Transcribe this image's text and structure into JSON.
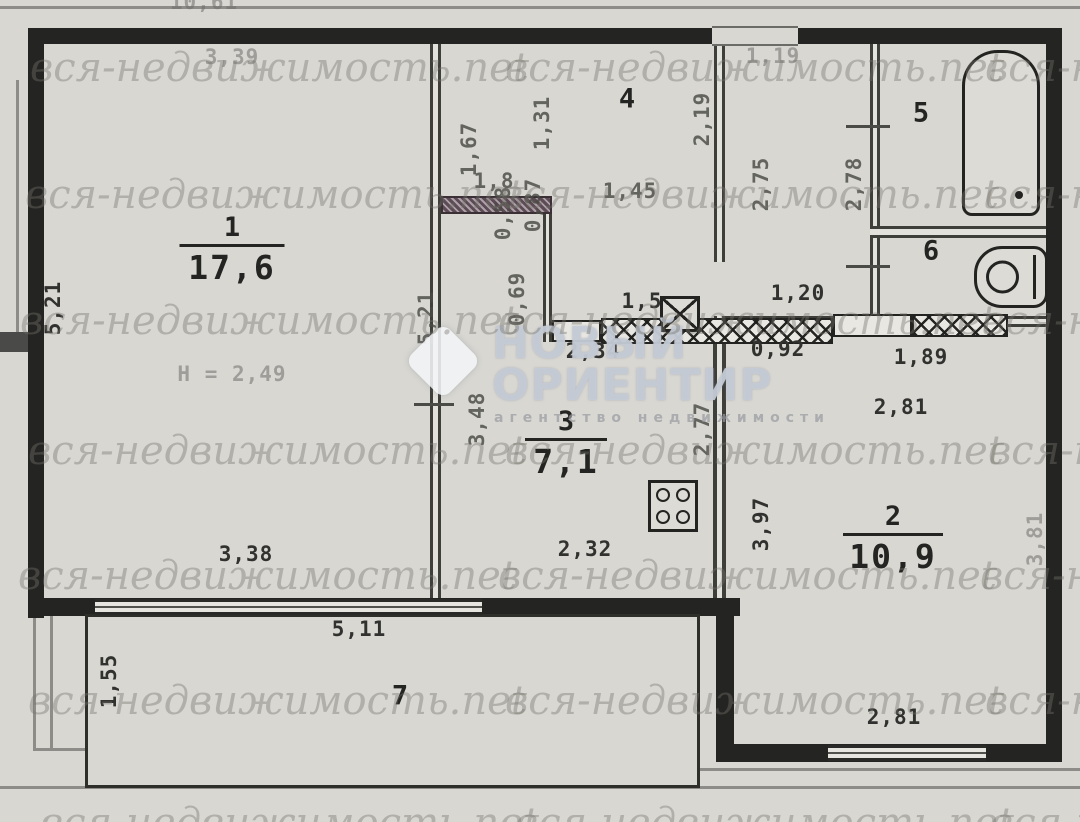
{
  "plan": {
    "rooms": [
      {
        "number": "1",
        "area": "17,6",
        "x": 232,
        "y": 214,
        "bar": 105
      },
      {
        "number": "3",
        "area": "7,1",
        "x": 566,
        "y": 408,
        "bar": 82
      },
      {
        "number": "2",
        "area": "10,9",
        "x": 893,
        "y": 503,
        "bar": 100
      },
      {
        "number": "4",
        "x": 627,
        "y": 99
      },
      {
        "number": "5",
        "x": 921,
        "y": 113
      },
      {
        "number": "6",
        "x": 931,
        "y": 251
      },
      {
        "number": "7",
        "x": 400,
        "y": 696
      }
    ],
    "dimensions": [
      {
        "text": "10,61",
        "x": 204,
        "y": 2,
        "cls": "faint"
      },
      {
        "text": "3,39",
        "x": 232,
        "y": 57,
        "cls": "faint"
      },
      {
        "text": "5,21",
        "x": 53,
        "y": 308,
        "rot": 1
      },
      {
        "text": "H = 2,49",
        "x": 232,
        "y": 374,
        "cls": "faint"
      },
      {
        "text": "3,38",
        "x": 246,
        "y": 554
      },
      {
        "text": "1,67",
        "x": 469,
        "y": 149,
        "rot": 1,
        "cls": "med"
      },
      {
        "text": "1,31",
        "x": 542,
        "y": 123,
        "rot": 1,
        "cls": "med"
      },
      {
        "text": "1,8",
        "x": 494,
        "y": 181,
        "cls": "med"
      },
      {
        "text": "0,87",
        "x": 533,
        "y": 205,
        "rot": 1,
        "cls": "med"
      },
      {
        "text": "0,58",
        "x": 503,
        "y": 213,
        "rot": 1,
        "cls": "med"
      },
      {
        "text": "0,69",
        "x": 517,
        "y": 299,
        "rot": 1,
        "cls": "med"
      },
      {
        "text": "1,45",
        "x": 630,
        "y": 191,
        "cls": "med"
      },
      {
        "text": "2,19",
        "x": 702,
        "y": 119,
        "rot": 1,
        "cls": "med"
      },
      {
        "text": "1,19",
        "x": 773,
        "y": 56,
        "cls": "faint"
      },
      {
        "text": "2,75",
        "x": 761,
        "y": 184,
        "rot": 1,
        "cls": "med"
      },
      {
        "text": "2,78",
        "x": 854,
        "y": 184,
        "rot": 1,
        "cls": "med"
      },
      {
        "text": "1,20",
        "x": 798,
        "y": 293
      },
      {
        "text": "0,92",
        "x": 778,
        "y": 349
      },
      {
        "text": "1,89",
        "x": 921,
        "y": 357
      },
      {
        "text": "2,81",
        "x": 901,
        "y": 407
      },
      {
        "text": "1,5",
        "x": 642,
        "y": 301
      },
      {
        "text": "2,34",
        "x": 593,
        "y": 351
      },
      {
        "text": "3,48",
        "x": 477,
        "y": 419,
        "rot": 1,
        "cls": "med"
      },
      {
        "text": "5,21",
        "x": 426,
        "y": 318,
        "rot": 1,
        "cls": "med"
      },
      {
        "text": "2,77",
        "x": 702,
        "y": 429,
        "rot": 1,
        "cls": "med"
      },
      {
        "text": "3,97",
        "x": 761,
        "y": 524,
        "rot": 1
      },
      {
        "text": "3,81",
        "x": 1035,
        "y": 539,
        "rot": 1,
        "cls": "faint"
      },
      {
        "text": "2,32",
        "x": 585,
        "y": 549
      },
      {
        "text": "5,11",
        "x": 359,
        "y": 629
      },
      {
        "text": "1,55",
        "x": 109,
        "y": 681,
        "rot": 1
      },
      {
        "text": "2,81",
        "x": 894,
        "y": 717
      }
    ]
  },
  "icons": {
    "bathtub": "css-rounded-rect-with-drain-dot",
    "toilet": "css-stadium-with-circle-bowl",
    "stove": "css-square-with-4-burner-circles",
    "vent-shaft": "css-square-with-diagonal-cross"
  },
  "watermark": {
    "text": "вся-недвижимость.net",
    "instances": [
      {
        "x": 30,
        "y": 45
      },
      {
        "x": 505,
        "y": 45
      },
      {
        "x": 985,
        "y": 45
      },
      {
        "x": 25,
        "y": 172
      },
      {
        "x": 500,
        "y": 172
      },
      {
        "x": 985,
        "y": 172
      },
      {
        "x": 20,
        "y": 298
      },
      {
        "x": 498,
        "y": 298
      },
      {
        "x": 982,
        "y": 298
      },
      {
        "x": 28,
        "y": 428
      },
      {
        "x": 505,
        "y": 428
      },
      {
        "x": 988,
        "y": 428
      },
      {
        "x": 18,
        "y": 553
      },
      {
        "x": 498,
        "y": 553
      },
      {
        "x": 980,
        "y": 553
      },
      {
        "x": 28,
        "y": 678
      },
      {
        "x": 505,
        "y": 678
      },
      {
        "x": 985,
        "y": 678
      },
      {
        "x": 40,
        "y": 800
      },
      {
        "x": 515,
        "y": 800
      },
      {
        "x": 990,
        "y": 800
      }
    ]
  },
  "logo": {
    "line1": "НОВЫЙ",
    "line2": "ОРИЕНТИР",
    "subtitle": "агентство недвижимости"
  }
}
